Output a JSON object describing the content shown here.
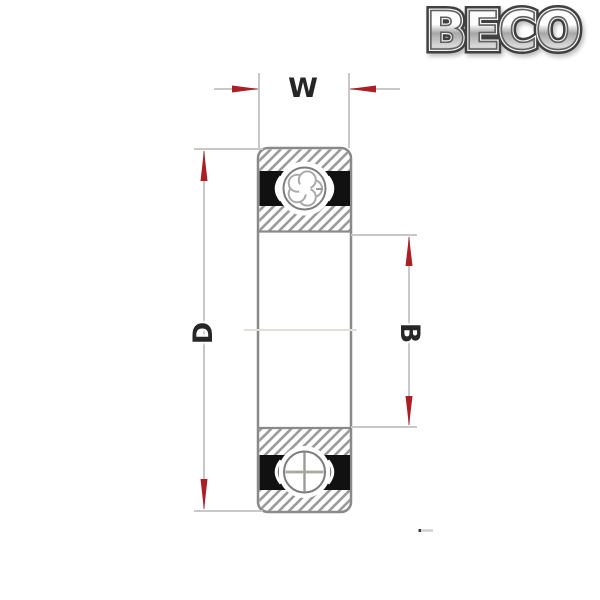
{
  "window": {
    "background": "#ffffff"
  },
  "logo": {
    "text": "BECO",
    "style": "chrome-outline"
  },
  "diagram": {
    "type": "sealed-ball-bearing-cross-section",
    "dimensions": {
      "width": {
        "label": "W",
        "orientation": "horizontal",
        "position": "top"
      },
      "outer_diameter": {
        "label": "D",
        "orientation": "vertical",
        "position": "left"
      },
      "inner_width": {
        "label": "B",
        "orientation": "vertical",
        "position": "right"
      }
    }
  },
  "colors": {
    "arrow_red": "#ab1e23",
    "dimension_line": "#c8c8c8",
    "outline_gray": "#8a8a8a",
    "hatch_gray": "#9b9b9b",
    "seal_black": "#111111",
    "label_text": "#262626",
    "centerline": "#dfe2d5",
    "logo_silver": "#d7d7d7",
    "logo_edge": "#404040"
  }
}
